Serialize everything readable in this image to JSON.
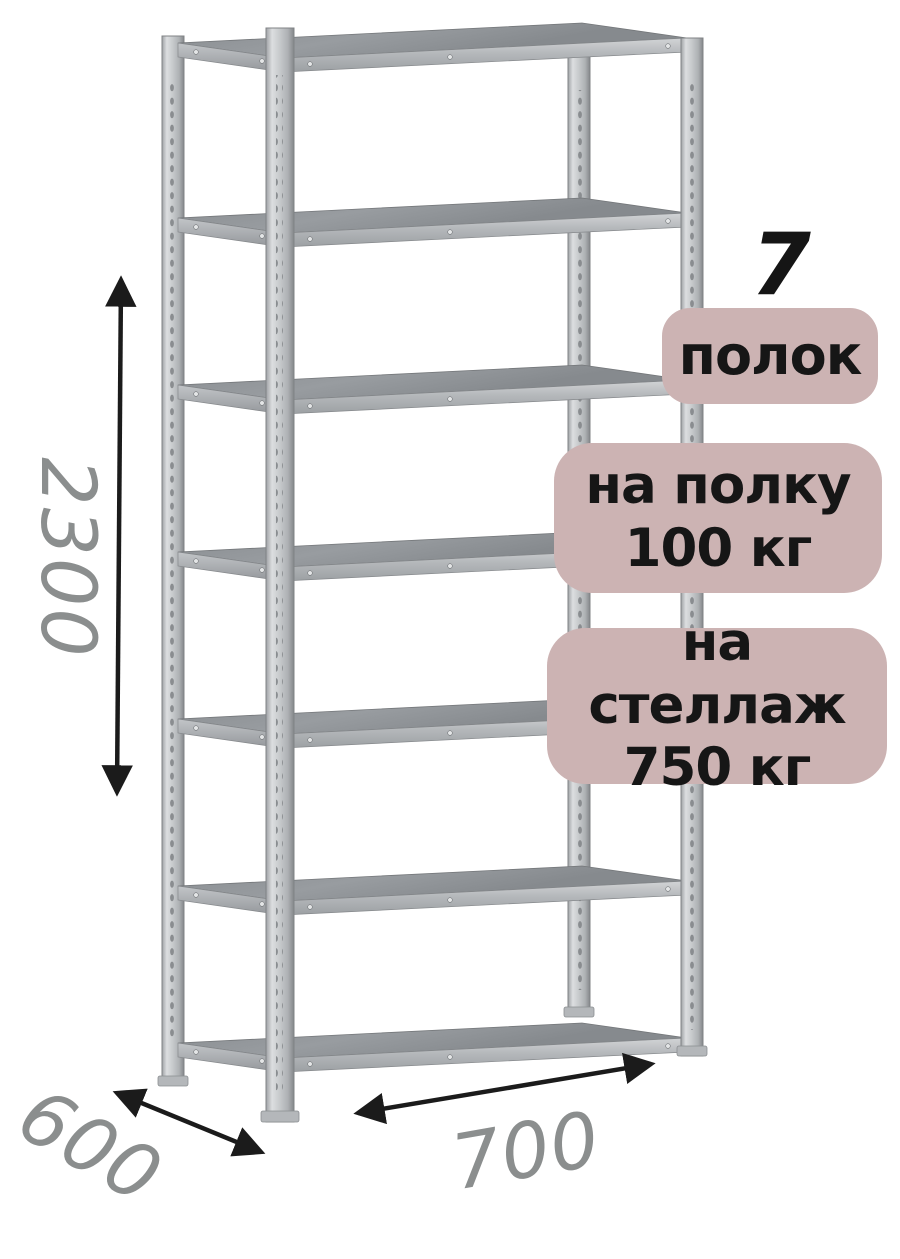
{
  "illustration": {
    "type": "metal-shelving-rack",
    "shelf_count_number": "7",
    "shelf_count_label": "полок",
    "shelf_load_line1": "на полку",
    "shelf_load_line2": "100 кг",
    "rack_load_line1": "на стеллаж",
    "rack_load_line2": "750 кг"
  },
  "dimensions": {
    "height_mm": "2300",
    "depth_mm": "600",
    "width_mm": "700"
  },
  "colors": {
    "background": "#ffffff",
    "badge_background": "#ccb3b3",
    "badge_text": "#161616",
    "dimension_text": "#8b8e8e",
    "arrow": "#1b1b1b",
    "metal_light": "#d9dbdd",
    "metal_mid": "#b5b8bb",
    "metal_dark": "#8f9397"
  }
}
